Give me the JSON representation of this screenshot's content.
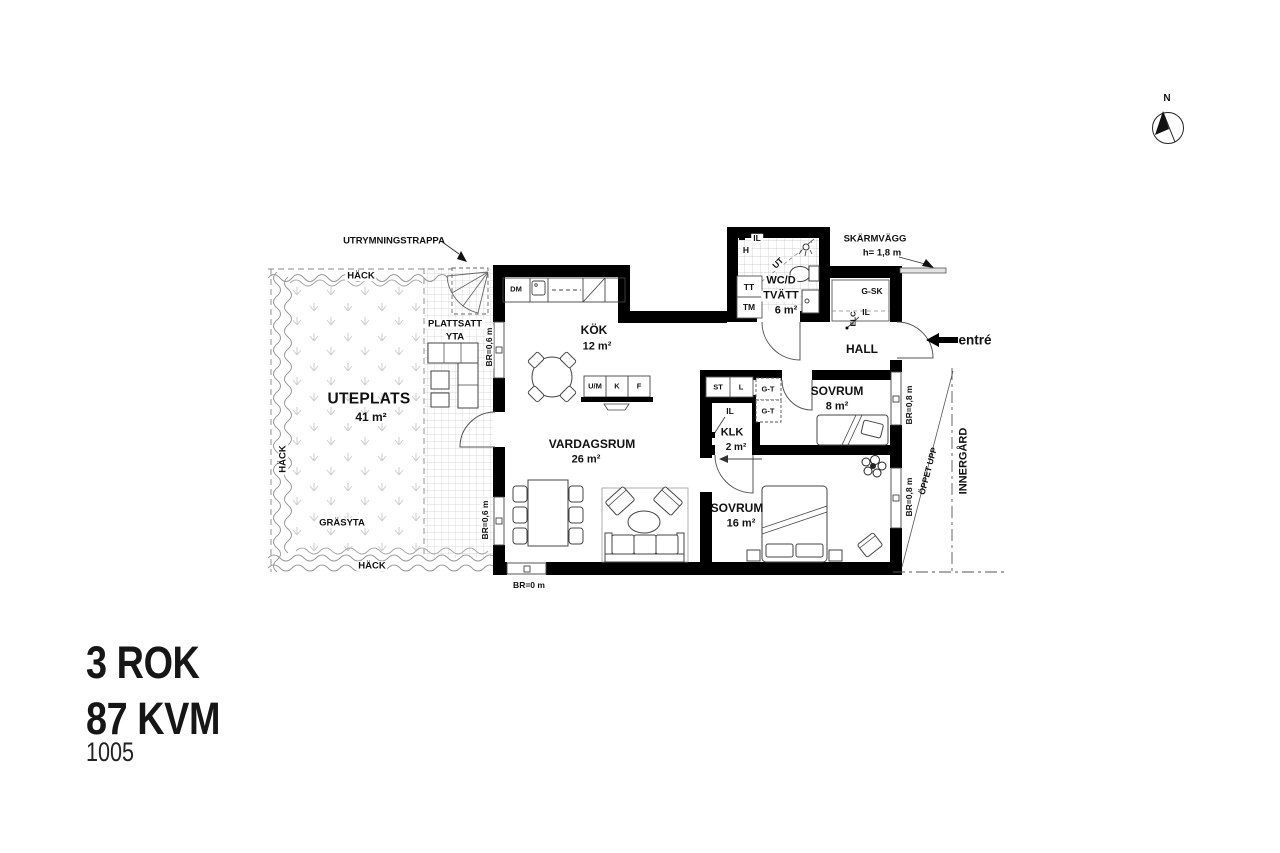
{
  "title": {
    "rooms": "3 ROK",
    "area": "87 KVM",
    "unit": "1005"
  },
  "compass": {
    "north": "N"
  },
  "annotations": {
    "escape_stairs": "UTRYMNINGSTRAPPA",
    "hedge": "HÄCK",
    "grass": "GRÄSYTA",
    "paved_line1": "PLATTSATT",
    "paved_line2": "YTA",
    "screen_wall": "SKÄRMVÄGG",
    "screen_wall_height": "h= 1,8 m",
    "entrance": "entré",
    "open_up": "ÖPPET UPP",
    "courtyard": "INNERGÅRD"
  },
  "rooms": {
    "uteplats": {
      "name": "UTEPLATS",
      "area": "41 m²"
    },
    "kok": {
      "name": "KÖK",
      "area": "12 m²"
    },
    "vardagsrum": {
      "name": "VARDAGSRUM",
      "area": "26 m²"
    },
    "wc": {
      "line1": "WC/D",
      "line2": "TVÄTT",
      "area": "6 m²"
    },
    "hall": {
      "name": "HALL"
    },
    "sovrum_8": {
      "name": "SOVRUM",
      "area": "8 m²"
    },
    "sovrum_16": {
      "name": "SOVRUM",
      "area": "16 m²"
    },
    "klk": {
      "name": "KLK",
      "area": "2 m²"
    }
  },
  "fixtures": {
    "dm": "DM",
    "um": "U/M",
    "k": "K",
    "f": "F",
    "tt": "TT",
    "tm": "TM",
    "h": "H",
    "ut": "UT",
    "il": "IL",
    "elc": "ELC",
    "gsk": "G-SK",
    "gt": "G-T",
    "st": "ST",
    "l": "L"
  },
  "measurements": {
    "br_left": "BR=0,6 m",
    "br_bottom": "BR=0 m",
    "br_right": "BR=0,8 m"
  },
  "colors": {
    "wall": "#000000",
    "line": "#444444",
    "hatch": "#c9c9c9",
    "hedge": "#999999"
  }
}
